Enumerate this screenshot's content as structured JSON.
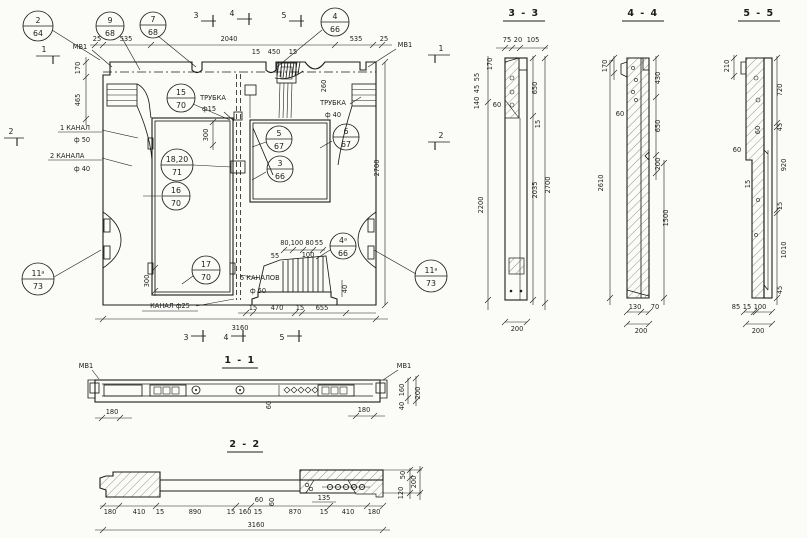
{
  "palette": {
    "ink": "#1c1c1c",
    "paper": "#fbfbf8"
  },
  "titles": {
    "s11": "1 - 1",
    "s22": "2 - 2",
    "s33": "3 - 3",
    "s44": "4 - 4",
    "s55": "5 - 5"
  },
  "marks": {
    "m1": "1",
    "m2": "2",
    "m3": "3",
    "m4": "4",
    "m5": "5"
  },
  "labels": {
    "mv1": "МВ1",
    "trubka": "ТРУБКА",
    "trubka15_d": "ф15",
    "trubka40_d": "ф 40",
    "kanal1": "1 КАНАЛ",
    "kanal1_d": "ф 50",
    "kanal2": "2 КАНАЛА",
    "kanal2_d": "ф 40",
    "kanal25": "КАНАЛ ф25",
    "kanal5": "5 КАНАЛОВ",
    "kanal5_d": "ф 50"
  },
  "callouts": {
    "c2": {
      "t": "2",
      "b": "64"
    },
    "c9": {
      "t": "9",
      "b": "68"
    },
    "c7": {
      "t": "7",
      "b": "68"
    },
    "c4": {
      "t": "4",
      "b": "66"
    },
    "c15": {
      "t": "15",
      "b": "70"
    },
    "c1820": {
      "t": "18,20",
      "b": "71"
    },
    "c16": {
      "t": "16",
      "b": "70"
    },
    "c17": {
      "t": "17",
      "b": "70"
    },
    "c5": {
      "t": "5",
      "b": "67"
    },
    "c3": {
      "t": "3",
      "b": "66"
    },
    "c6": {
      "t": "6",
      "b": "67"
    },
    "c4a": {
      "t": "4ᵃ",
      "b": "66"
    },
    "c11aL": {
      "t": "11ᵃ",
      "b": "73"
    },
    "c11aR": {
      "t": "11ᵃ",
      "b": "73"
    }
  },
  "main": {
    "top25l": "25",
    "top535l": "535",
    "top2040": "2040",
    "top15a": "15",
    "top450": "450",
    "top15b": "15",
    "top535r": "535",
    "top25r": "25",
    "left170": "170",
    "left465": "465",
    "v300top": "300",
    "v260": "260",
    "v300bot": "300",
    "v40": "40",
    "right2700": "2700",
    "cl55l": "55",
    "clrow": "80,100 80",
    "cl55r": "55",
    "cl100": "100",
    "bot15a": "15",
    "bot470": "470",
    "bot15b": "15",
    "bot655": "655",
    "bot3160": "3160"
  },
  "s33": {
    "top75": "75",
    "top20": "20",
    "top105": "105",
    "l170": "170",
    "l55": "55",
    "l45": "45",
    "l140": "140",
    "d60": "60",
    "r650": "650",
    "r15": "15",
    "l2200": "2200",
    "r2035": "2035",
    "r2700": "2700",
    "b200": "200"
  },
  "s44": {
    "l170": "170",
    "r430": "430",
    "d60": "60",
    "r650": "650",
    "r200": "200",
    "r1500": "1500",
    "l2610": "2610",
    "b130": "130",
    "b70": "70",
    "b200": "200"
  },
  "s55": {
    "l210": "210",
    "r720": "720",
    "r45a": "45",
    "d60a": "60",
    "d60b": "60",
    "d15": "15",
    "r920": "920",
    "r15": "15",
    "r1010": "1010",
    "r45b": "45",
    "b85": "85",
    "b15": "15",
    "b100": "100",
    "b200": "200"
  },
  "s11": {
    "l180": "180",
    "r180": "180",
    "v60": "60",
    "r160": "160",
    "r40": "40",
    "r200": "200"
  },
  "s22": {
    "b180l": "180",
    "b410l": "410",
    "b15a": "15",
    "b890": "890",
    "b15b": "15",
    "b160": "160",
    "b15c": "15",
    "b870": "870",
    "b15d": "15",
    "b410r": "410",
    "b180r": "180",
    "b3160": "3160",
    "d60a": "60",
    "d60b": "60",
    "d135": "135",
    "r50": "50",
    "r200": "200",
    "r120": "120"
  }
}
